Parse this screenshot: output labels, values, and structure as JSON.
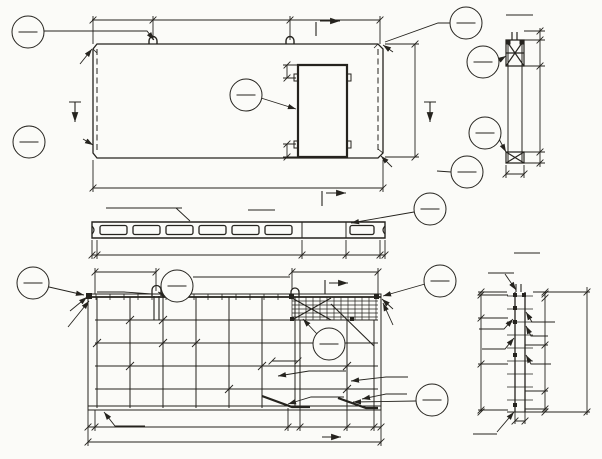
{
  "plan_view": {
    "dims": {
      "d1360": "1360",
      "d3000": "3000",
      "d1860": "1860",
      "d6220": "6220",
      "d2650": "2650",
      "d300_top": "300",
      "d300_bot": "300"
    },
    "labels": {
      "mv2_left": "МВ2",
      "mv2_right": "МВ2",
      "shponki_left": "ШПОНКИ",
      "shponki_right": "ШПОНКИ"
    },
    "section_marks": {
      "s1_left": "1",
      "s1_right": "1",
      "s2_top": "2"
    },
    "callouts": {
      "c24": {
        "top": "2",
        "bottom": "4"
      },
      "c64": {
        "top": "6",
        "bottom": "4"
      },
      "c14": {
        "top": "1",
        "bottom": "4"
      },
      "c2_6_left": {
        "top": "II",
        "bottom": "6"
      },
      "c2_6_right": {
        "top": "II",
        "bottom": "6"
      }
    }
  },
  "section_2_2": {
    "title": "2-2",
    "dims": {
      "d50": "50",
      "d490": "490",
      "d2120": "2120",
      "d40": "40",
      "d120": "120"
    },
    "callouts": {
      "c34": {
        "top": "3",
        "bottom": "4"
      },
      "c44": {
        "top": "4",
        "bottom": "4"
      }
    }
  },
  "section_1_1": {
    "title": "1-1",
    "label": "АБВ1.3-62-2.4",
    "dims": {
      "d60_left": "60",
      "d4580": "4580",
      "d890": "890",
      "d750": "750",
      "d60_right": "60"
    },
    "section_marks": {
      "s2": "2"
    },
    "callouts": {
      "c54": {
        "top": "5",
        "bottom": "4"
      }
    }
  },
  "bottom_view": {
    "title": "АБВ1.3-62-2.4",
    "dims": {
      "d1300": "1300",
      "d1800": "1800",
      "d500": "500",
      "d20_left": "20",
      "d4200": "700х6=4200",
      "d260": "260",
      "d1010": "1010",
      "d630": "630",
      "d20_right": "20",
      "d6140": "6140"
    },
    "labels": {
      "lv3": "ЛВ3",
      "mv2_left": "МВ2",
      "av2_left": "АВ2",
      "mv2_right": "МВ2",
      "av2_right": "АВ2",
      "tv121": "ТВ 121",
      "kv1": "КВ1",
      "pkv51": "ПКВ 51",
      "tv6": "ТВ 6",
      "tv69": "ТВ 69"
    },
    "section_marks": {
      "s3_top": "3",
      "s3_bottom": "3"
    },
    "callouts": {
      "c1a13": {
        "top": "1А",
        "bottom": "13"
      },
      "c213": {
        "top": "2",
        "bottom": "13"
      },
      "c112": {
        "top": "1",
        "bottom": "12"
      },
      "c314": {
        "top": "3",
        "bottom": "14"
      },
      "c411": {
        "top": "4",
        "bottom": "11"
      }
    }
  },
  "section_3_3": {
    "title": "3-3",
    "top_label": "ТВ 97",
    "dims_left": [
      "55",
      "500",
      "1000",
      "1000",
      "55"
    ],
    "dims_right": [
      "15",
      "40",
      "1000",
      "1000",
      "500",
      "55"
    ],
    "dim_total": "2610",
    "dim_70": "70",
    "labels": {
      "kv23": "КВ23",
      "av2": "АВ2",
      "kv41": "КВ41",
      "kv1": "КВ1",
      "tv6": "ТВ 6",
      "pkv51": "ПКВ 51"
    }
  }
}
